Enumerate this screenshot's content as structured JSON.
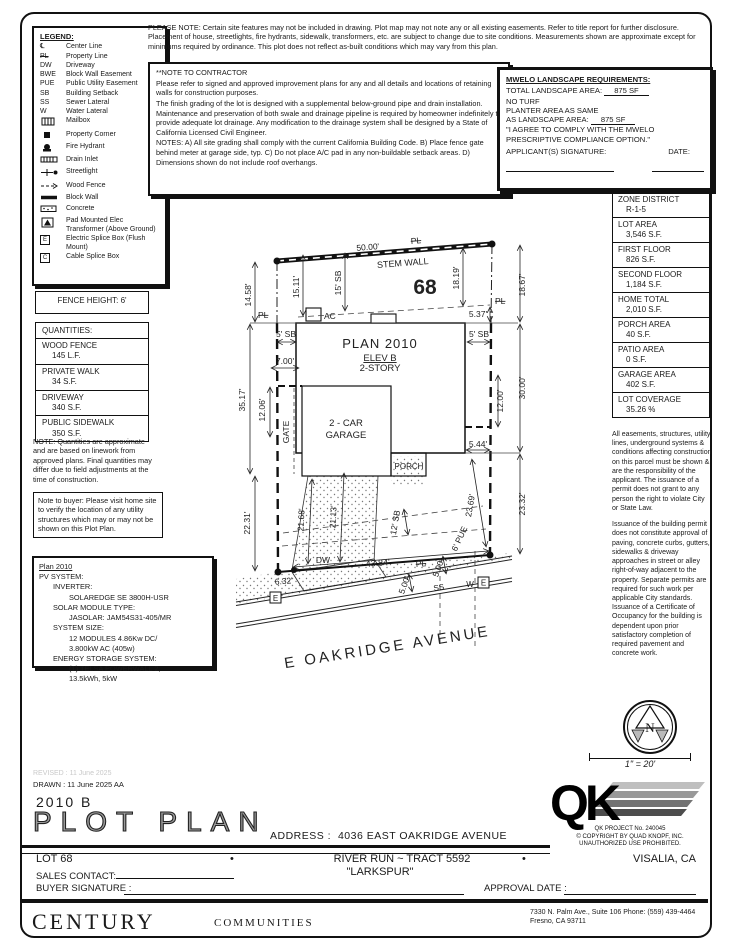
{
  "legend": {
    "title": "LEGEND:",
    "items": [
      {
        "sym": "℄",
        "label": "Center Line"
      },
      {
        "sym": "PL",
        "label": "Property Line"
      },
      {
        "sym": "DW",
        "label": "Driveway"
      },
      {
        "sym": "BWE",
        "label": "Block Wall Easement"
      },
      {
        "sym": "PUE",
        "label": "Public Utility Easement"
      },
      {
        "sym": "SB",
        "label": "Building Setback"
      },
      {
        "sym": "SS",
        "label": "Sewer Lateral"
      },
      {
        "sym": "W",
        "label": "Water Lateral"
      },
      {
        "sym": "",
        "label": "Mailbox"
      },
      {
        "sym": "",
        "label": "Property Corner"
      },
      {
        "sym": "",
        "label": "Fire Hydrant"
      },
      {
        "sym": "",
        "label": "Drain Inlet"
      },
      {
        "sym": "",
        "label": "Streetlight"
      },
      {
        "sym": "",
        "label": "Wood Fence"
      },
      {
        "sym": "",
        "label": "Block Wall"
      },
      {
        "sym": "",
        "label": "Concrete"
      },
      {
        "sym": "",
        "label": "Pad Mounted Elec Transformer (Above Ground)"
      },
      {
        "sym": "E",
        "label": "Electric Splice Box (Flush Mount)"
      },
      {
        "sym": "C",
        "label": "Cable Splice Box"
      }
    ]
  },
  "please_note": "PLEASE NOTE:  Certain site features may not be included in drawing.  Plot map may not note any or all existing easements. Refer to title report for further disclosure.  Placement of house, streetlights, fire hydrants, sidewalk, transformers, etc. are subject to change due to site conditions.  Measurements shown are approximate except for minimums required by ordinance.  This plot does not reflect as-built conditions which may vary from this plan.",
  "contractor_note": {
    "title": "**NOTE TO CONTRACTOR",
    "p1": "Please refer to signed and approved improvement plans for any and all details and locations of retaining walls for construction purposes.",
    "p2": "The finish grading of the lot is designed with a supplemental below-ground pipe and drain installation.  Maintenance and preservation of both swale and drainage pipeline is required by homeowner indefinitely to provide adequate lot drainage.  Any modification to the drainage system shall be designed by a State of California Licensed Civil Engineer.",
    "p3": "NOTES:  A) All site grading shall comply with the current California Building Code. B) Place fence gate behind meter at garage side, typ.  C) Do not place A/C pad in any non-buildable setback areas.  D) Dimensions shown do not include roof overhangs."
  },
  "mwelo": {
    "title": "MWELO LANDSCAPE REQUIREMENTS:",
    "total_label": "TOTAL LANDSCAPE AREA:",
    "total_value": "875 SF",
    "no_turf": "NO TURF",
    "planter_line1": "PLANTER AREA AS SAME",
    "planter_label": "AS LANDSCAPE AREA:",
    "planter_value": "875 SF",
    "agree": "\"I AGREE TO COMPLY WITH THE MWELO PRESCRIPTIVE COMPLIANCE OPTION.\"",
    "sig_label": "APPLICANT(S) SIGNATURE:",
    "date_label": "DATE:"
  },
  "zone_table": {
    "rows": [
      [
        "ZONE DISTRICT",
        "R-1-5"
      ],
      [
        "LOT AREA",
        "3,546 S.F."
      ],
      [
        "FIRST FLOOR",
        "826 S.F."
      ],
      [
        "SECOND FLOOR",
        "1,184 S.F."
      ],
      [
        "HOME TOTAL",
        "2,010 S.F."
      ],
      [
        "PORCH AREA",
        "40 S.F."
      ],
      [
        "PATIO AREA",
        "0 S.F."
      ],
      [
        "GARAGE AREA",
        "402 S.F."
      ],
      [
        "LOT COVERAGE",
        "35.26 %"
      ]
    ]
  },
  "fence_height": "FENCE HEIGHT: 6'",
  "quantities": {
    "title": "QUANTITIES:",
    "rows": [
      [
        "WOOD FENCE",
        "145 L.F."
      ],
      [
        "PRIVATE WALK",
        "34 S.F."
      ],
      [
        "DRIVEWAY",
        "340 S.F."
      ],
      [
        "PUBLIC SIDEWALK",
        "350 S.F."
      ]
    ]
  },
  "quantities_note": "NOTE: Quantities are approximate and are based on linework from approved plans. Final quantities may differ due to field adjustments at the time of construction.",
  "buyer_note": "Note to buyer: Please visit home site to verify the location of any utility structures which may or may not be shown on this Plot Plan.",
  "pv": {
    "title": "Plan 2010",
    "l1": "PV SYSTEM:",
    "l2": "INVERTER:",
    "l3": "SOLAREDGE SE 3800H-USR",
    "l4": "SOLAR MODULE TYPE:",
    "l5": "JASOLAR: JAM54S31-405/MR",
    "l6": "SYSTEM SIZE:",
    "l7": "12 MODULES 4.86Kw DC/",
    "l8": "3.800kW AC (405w)",
    "l9": "ENERGY STORAGE SYSTEM:",
    "l10": "(1) TELSA POWERWALL 2,",
    "l11": "13.5kWh, 5kW"
  },
  "legal": {
    "p1": "All easements, structures, utility lines, underground systems & conditions affecting construction on this parcel must be shown & are the responsibility of the applicant. The issuance of a permit does not grant to any person the right to violate City or State Law.",
    "p2": "Issuance of the building permit does not constitute approval of paving, concrete curbs, gutters, sidewalks & driveway approaches in street or alley right-of-way adjacent to the property. Separate permits are required for such work per applicable City standards. Issuance of a Certificate of Occupancy for the building is dependent upon prior satisfactory completion of required pavement and concrete work."
  },
  "plot": {
    "labels": {
      "dim_top": "50.00'",
      "pl_top": "PL",
      "stem_wall": "STEM WALL",
      "lot_no": "68",
      "d1458": "14.58'",
      "pl_left": "PL",
      "d1511": "15.11'",
      "sb15": "15' SB",
      "d1819": "18.19'",
      "d1867": "18.67'",
      "pl_right": "PL",
      "d537": "5.37'",
      "ac": "AC",
      "sb5l": "5' SB",
      "sb5r": "5' SB",
      "plan": "PLAN 2010",
      "elev": "ELEV B",
      "story": "2-STORY",
      "d700": "7.00'",
      "d3517": "35.17'",
      "d1206": "12.06'",
      "gate": "GATE",
      "d2231": "22.31'",
      "d3000": "30.00'",
      "d1200": "12.00'",
      "d544": "5.44'",
      "gar1": "2 - CAR",
      "gar2": "GARAGE",
      "porch": "PORCH",
      "d2168": "21.68'",
      "d2113": "21.13'",
      "sb12": "12' SB",
      "pue6": "6' PUE",
      "d2369": "23.69'",
      "d2332": "23.32'",
      "dw": "DW",
      "d632": "6.32'",
      "d4384": "43.84'",
      "pl_bot": "PL",
      "d500a": "5.00'",
      "d500b": "5.00'",
      "ss": "SS",
      "w": "W",
      "e_right": "E",
      "e_left": "E",
      "street": "E OAKRIDGE AVENUE"
    }
  },
  "compass": {
    "north": "N"
  },
  "scale": "1\" = 20'",
  "qk": {
    "letters": "QK",
    "line1": "QK PROJECT No. 240045",
    "line2": "© COPYRIGHT BY QUAD KNOPF, INC.",
    "line3": "UNAUTHORIZED USE PROHIBITED."
  },
  "titleblock": {
    "revised": "REVISED : 11 June 2025",
    "drawn": "DRAWN :  11 June 2025  AA",
    "plan_no": "2010 B",
    "title": "PLOT PLAN",
    "address_label": "ADDRESS :",
    "address": "4036 EAST OAKRIDGE AVENUE",
    "lot": "LOT 68",
    "bullet": "•",
    "tract": "RIVER RUN ~ TRACT 5592",
    "model": "\"LARKSPUR\"",
    "city": "VISALIA, CA",
    "sales_label": "SALES CONTACT:",
    "buyer_label": "BUYER SIGNATURE :",
    "approval_label": "APPROVAL DATE :"
  },
  "footer": {
    "brand": "CENTURY",
    "brand2": "COMMUNITIES",
    "addr1": "7330 N. Palm Ave., Suite 106    Phone:  (559) 439-4464",
    "addr2": "Fresno, CA  93711"
  }
}
